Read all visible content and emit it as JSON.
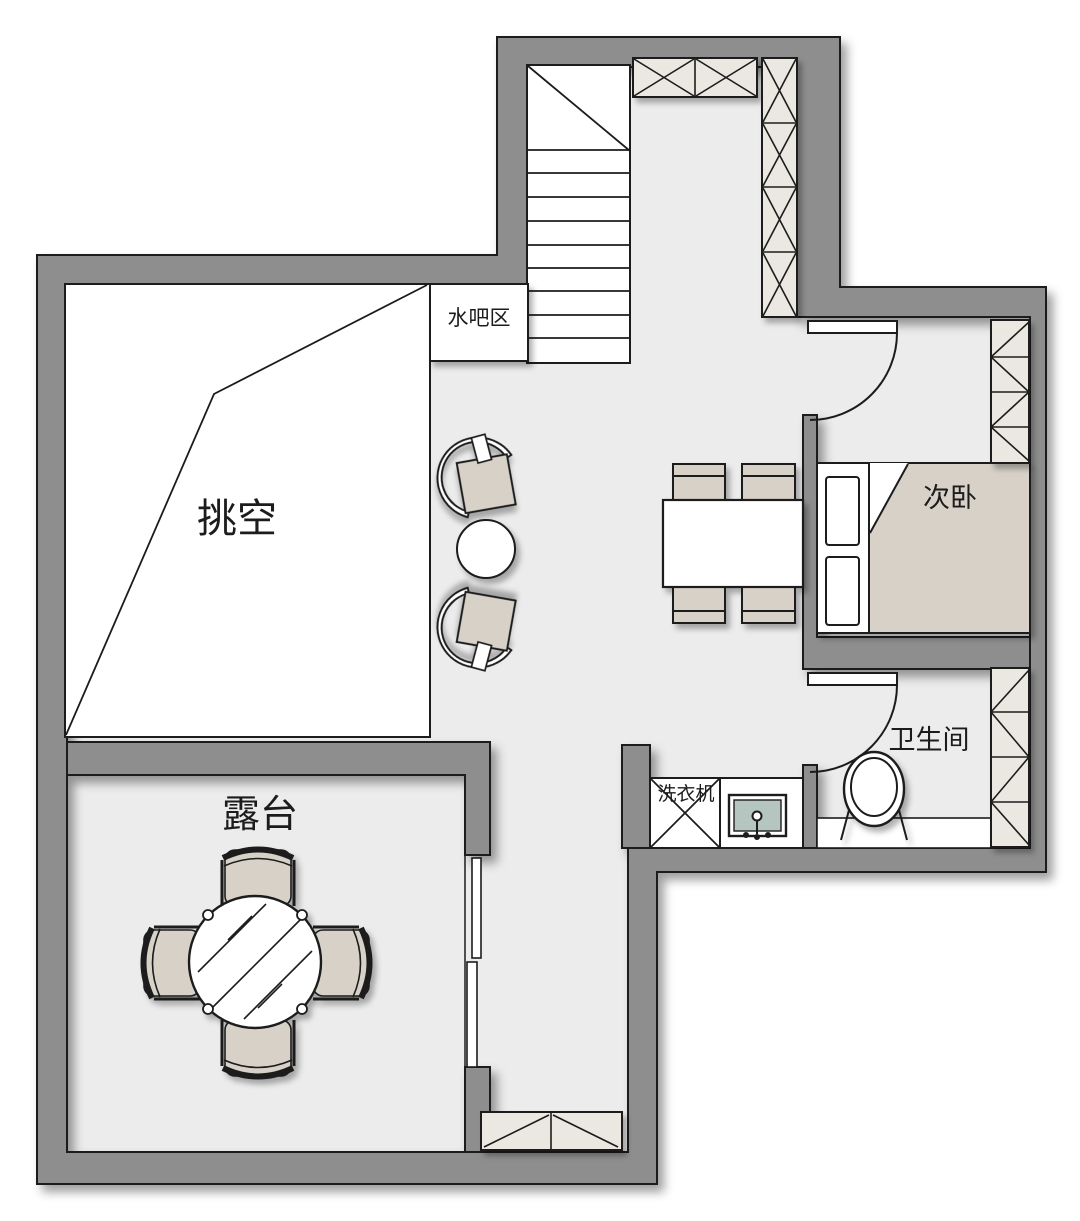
{
  "plan_title": "二层户型图",
  "palette": {
    "wall": "#8e8e8e",
    "floor": "#ececec",
    "line": "#1c1c1c",
    "furniture_tan": "#d7d1c8",
    "cabinet_cream": "#eae8e1",
    "sink_teal": "#b5c6c0",
    "room_white": "#ffffff"
  },
  "rooms": {
    "void": {
      "label": "挑空"
    },
    "water_bar": {
      "label": "水吧区"
    },
    "secondary_bedroom": {
      "label": "次卧"
    },
    "bathroom": {
      "label": "卫生间"
    },
    "washing_machine": {
      "label": "洗衣机"
    },
    "terrace": {
      "label": "露台"
    }
  },
  "furniture_legend": {
    "stairs": "stairs",
    "wardrobes": "x-pattern wardrobe cabinets",
    "bed": "double bed with pillows",
    "toilet": "toilet",
    "sink": "wash basin",
    "dining": "dining table with four chairs",
    "lounge": "two lounge chairs with side table",
    "terrace_set": "round glass table with four chairs",
    "sliding_door": "sliding door",
    "shoe_cabinet": "low cabinet"
  }
}
